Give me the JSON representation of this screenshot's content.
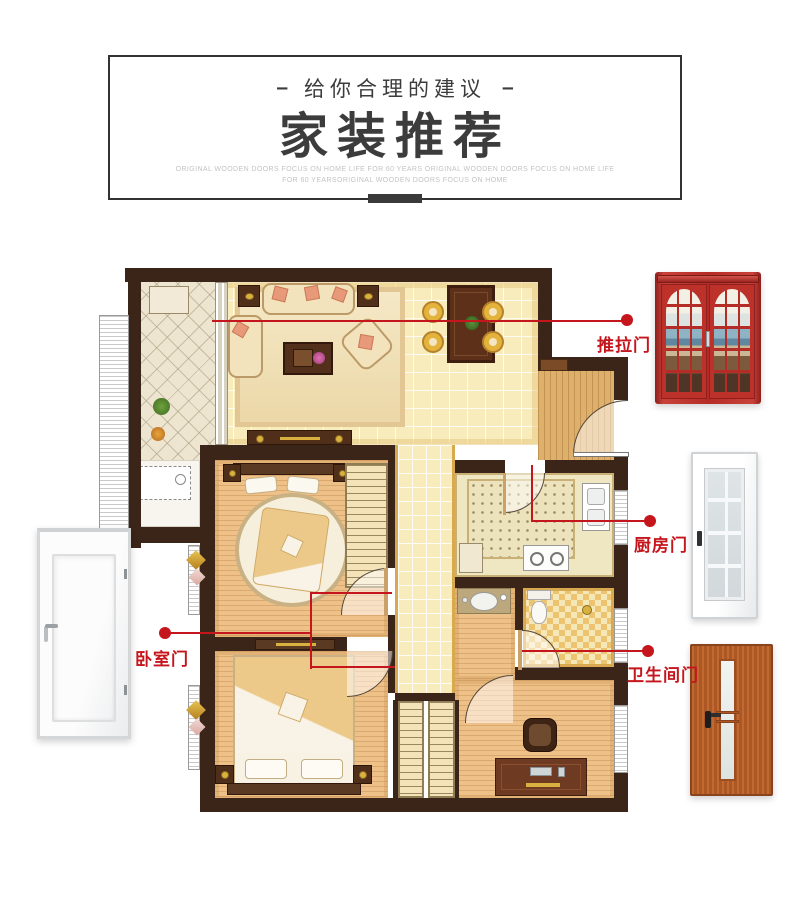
{
  "header": {
    "dash_left": "–",
    "dash_right": "–",
    "tagline": "给你合理的建议",
    "title": "家装推荐",
    "subtitle_line1": "ORIGINAL WOODEN DOORS FOCUS ON HOME LIFE FOR 60 YEARS ORIGINAL WOODEN DOORS FOCUS ON HOME LIFE",
    "subtitle_line2": "FOR 60 YEARSORIGINAL WOODEN DOORS FOCUS ON HOME"
  },
  "callouts": [
    {
      "id": "sliding-door",
      "label": "推拉门"
    },
    {
      "id": "kitchen-door",
      "label": "厨房门"
    },
    {
      "id": "bathroom-door",
      "label": "卫生间门"
    },
    {
      "id": "bedroom-door",
      "label": "卧室门"
    }
  ],
  "colors": {
    "accent": "#c5161d",
    "wall": "#3b2418",
    "tile": "#f8ebbc",
    "wood": "#eec189",
    "gold": "#d9b13f",
    "darkwood": "#52301c",
    "titlecolor": "#3c3c3c",
    "subtitlecolor": "#c3c3c3"
  }
}
